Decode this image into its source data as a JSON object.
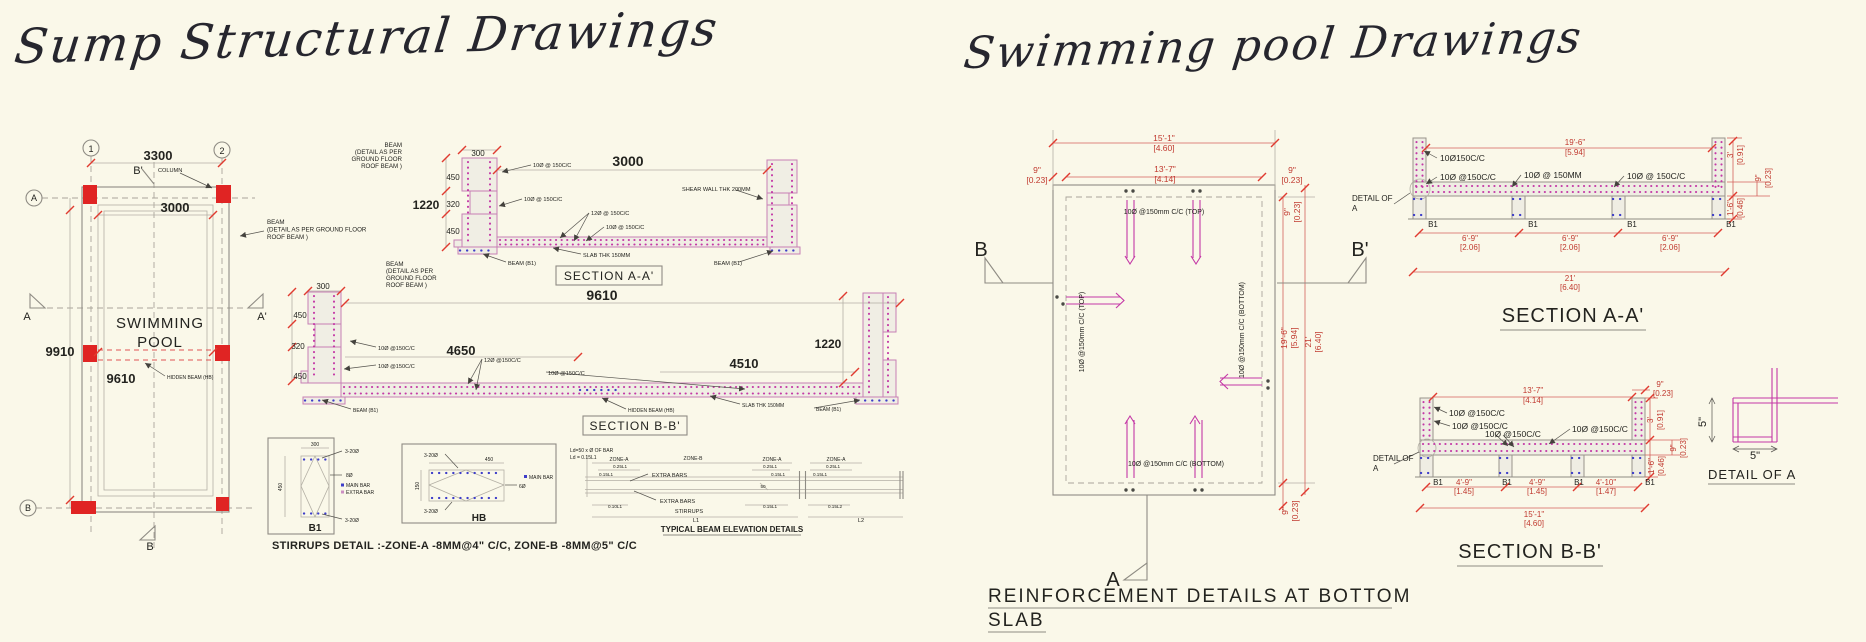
{
  "titles": {
    "left": "Sump Structural Drawings",
    "right": "Swimming pool Drawings"
  },
  "plan_left": {
    "grid1": "1",
    "grid2": "2",
    "gridA": "A",
    "gridB": "B",
    "dim_3300": "3300",
    "dim_3000": "3000",
    "dim_9910": "9910",
    "dim_9610": "9610",
    "b_prime": "B'",
    "column": "COLUMN",
    "beam_note": [
      "BEAM",
      "(DETAIL AS PER GROUND FLOOR",
      "ROOF BEAM )"
    ],
    "a_left": "A",
    "a_right": "A'",
    "pool1": "SWIMMING",
    "pool2": "POOL",
    "hidden_beam": "HIDDEN BEAM (HB)",
    "b_bottom": "B"
  },
  "sec_aa_left": {
    "beam_note": [
      "BEAM",
      "(DETAIL AS PER",
      "GROUND FLOOR",
      "ROOF BEAM )"
    ],
    "dim_300": "300",
    "dim_3000": "3000",
    "dim_450a": "450",
    "dim_320": "320",
    "dim_450b": "450",
    "dim_1220": "1220",
    "r1": "10Ø @ 150C/C",
    "r2": "10Ø @ 150C/C",
    "r3": "12Ø @ 150C/C",
    "r4": "10Ø @ 150C/C",
    "shear": "SHEAR WALL THK 200MM",
    "slab": "SLAB THK 150MM",
    "b1_left": "BEAM (B1)",
    "b1_right": "BEAM (B1)",
    "title": "SECTION A-A'"
  },
  "sec_bb_left": {
    "beam_note": [
      "BEAM",
      "(DETAIL AS PER",
      "GROUND FLOOR",
      "ROOF BEAM )"
    ],
    "dim_300": "300",
    "dim_9610": "9610",
    "dim_450a": "450",
    "dim_320": "320",
    "dim_450b": "450",
    "dim_4650": "4650",
    "dim_4510": "4510",
    "dim_1220": "1220",
    "r1": "10Ø @150C/C",
    "r2": "10Ø @150C/C",
    "r3": "12Ø @150C/C",
    "r4": "10Ø @150C/C",
    "b1_left": "BEAM (B1)",
    "hidden": "HIDDEN BEAM (HB)",
    "slab": "SLAB THK 150MM",
    "b1_right": "BEAM (B1)",
    "title": "SECTION B-B'"
  },
  "b1_detail": {
    "dim_300": "300",
    "dim_450": "450",
    "top": "3-20Ø",
    "mid": "8Ø",
    "legend1": "MAIN BAR",
    "legend2": "EXTRA BAR",
    "bottom": "3-20Ø",
    "name": "B1"
  },
  "hb_detail": {
    "top": "3-20Ø",
    "dim_450": "450",
    "dim_150": "150",
    "legend1": "MAIN BAR",
    "mid": "6Ø",
    "bottom": "3-20Ø",
    "name": "HB"
  },
  "stirrups_note": "STIRRUPS DETAIL :-ZONE-A -8MM@4\" C/C,  ZONE-B -8MM@5\" C/C",
  "beam_elev": {
    "ld1": "Ld=50 x Ø OF BAR",
    "ld2": "Ld = 0.15L1",
    "zoneA1": "ZONE-A",
    "zoneB": "ZONE-B",
    "zoneA2": "ZONE-A",
    "zoneA3": "ZONE-A",
    "q1": "0.25L1",
    "q2": "0.25L1",
    "q3": "0.25L1",
    "f1": "0.15L1",
    "f2": "0.15L1",
    "f3": "0.15L1",
    "extra1": "EXTRA BARS",
    "extra2": "EXTRA BARS",
    "t1": "0.10L1",
    "t2": "0.15L1",
    "t3": "0.15L2",
    "fifty": "50",
    "stirrups": "STIRRUPS",
    "l1": "L1",
    "l2": "L2",
    "title": "TYPICAL BEAM ELEVATION DETAILS"
  },
  "plan_right": {
    "dim_151": "15'-1\"",
    "dim_151m": "[4.60]",
    "dim_137": "13'-7\"",
    "dim_137m": "[4.14]",
    "dim_9L": "9\"",
    "dim_9Lm": "[0.23]",
    "dim_9R": "9\"",
    "dim_9Rm": "[0.23]",
    "dim_9Rv": "9\"",
    "dim_9Rvm": "[0.23]",
    "dim_196": "19'-6\"",
    "dim_196m": "[5.94]",
    "dim_21": "21'",
    "dim_21m": "[6.40]",
    "dim_9B": "9\"",
    "dim_9Bm": "[0.23]",
    "top_bar": "10Ø @150mm C/C (TOP)",
    "bottom_bar": "10Ø @150mm C/C (BOTTOM)",
    "left_bar": "10Ø @150mm C/C (TOP)",
    "right_bar": "10Ø @150mm C/C (BOTTOM)",
    "b": "B",
    "b_prime": "B'",
    "a": "A",
    "title1": "REINFORCEMENT DETAILS AT BOTTOM",
    "title2": "SLAB"
  },
  "sec_aa_right": {
    "dim_196": "19'-6\"",
    "dim_196m": "[5.94]",
    "r1": "10Ø150C/C",
    "r2": "10Ø @150C/C",
    "r3": "10Ø @ 150MM",
    "r4": "10Ø @ 150C/C",
    "detail1": "DETAIL OF",
    "detail2": "A",
    "b1": [
      "B1",
      "B1",
      "B1",
      "B1"
    ],
    "d69": "6'-9\"",
    "d69m": "[2.06]",
    "dim_3": "3'",
    "dim_3m": "[0.91]",
    "dim_9": "9\"",
    "dim_9m": "[0.23]",
    "dim_16": "1'-6\"",
    "dim_16m": "[0.46]",
    "dim_21": "21'",
    "dim_21m": "[6.40]",
    "title": "SECTION A-A'"
  },
  "sec_bb_right": {
    "dim_137": "13'-7\"",
    "dim_137m": "[4.14]",
    "dim_9t": "9\"",
    "dim_9tm": "[0.23]",
    "r1": "10Ø @150C/C",
    "r2": "10Ø @150C/C",
    "r3": "10Ø @150C/C",
    "r4": "10Ø @150C/C",
    "detail1": "DETAIL OF",
    "detail2": "A",
    "b1": [
      "B1",
      "B1",
      "B1",
      "B1"
    ],
    "d1": "4'-9\"",
    "d1m": "[1.45]",
    "d2": "4'-9\"",
    "d2m": "[1.45]",
    "d3": "4'-10\"",
    "d3m": "[1.47]",
    "dim_151": "15'-1\"",
    "dim_151m": "[4.60]",
    "dim_3": "3'",
    "dim_3m": "[0.91]",
    "dim_9": "9\"",
    "dim_9m": "[0.23]",
    "dim_16": "1'-6\"",
    "dim_16m": "[0.46]",
    "title": "SECTION B-B'"
  },
  "detail_a": {
    "dim_5v": "5\"",
    "dim_5h": "5\"",
    "title": "DETAIL OF A"
  },
  "colors": {
    "column_red": "#e02423",
    "rebar_magenta": "#c438a6",
    "rebar_blue": "#3d3dc9",
    "dim_red": "#c0392f",
    "line_gray": "#8f8c84",
    "background": "#faf8e9"
  }
}
